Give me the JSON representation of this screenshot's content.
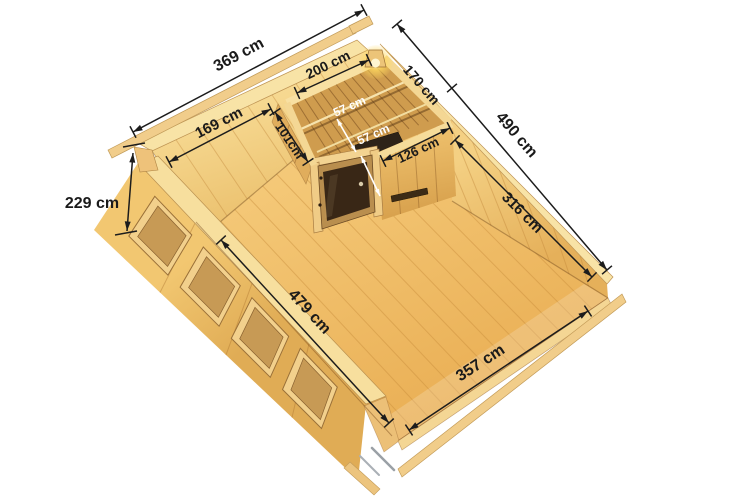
{
  "diagram": {
    "dimensions": {
      "outer_width": "369 cm",
      "outer_depth": "490 cm",
      "wall_height": "229 cm",
      "left_wall_segment": "169 cm",
      "sauna_back_wall": "200 cm",
      "sauna_right_side": "170 cm",
      "sauna_left_wall": "101cm",
      "sauna_front_wall": "126 cm",
      "right_wall_inner": "316 cm",
      "floor_depth_inner": "479 cm",
      "floor_width_inner": "357 cm",
      "bench_upper_depth": "57 cm",
      "bench_lower_depth": "57 cm"
    },
    "colors": {
      "wood_light": "#f8e3a6",
      "wood_mid": "#e9bc67",
      "floor": "#eeb85f",
      "dimension_line": "#1c1c1c",
      "door_glass": "#392716",
      "lamp_glow": "#ffd95e"
    }
  }
}
